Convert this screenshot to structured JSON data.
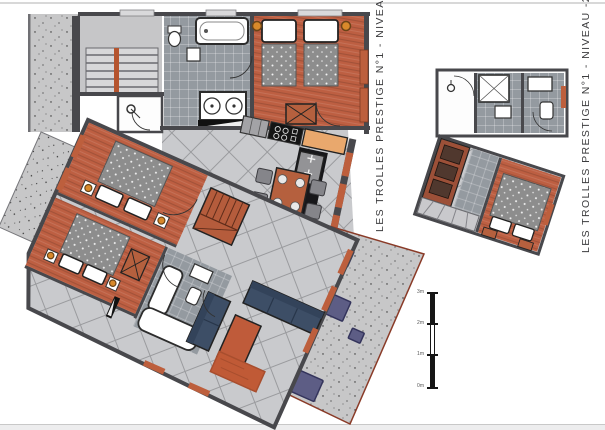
{
  "sheet": {
    "type": "architectural floor plan drawing",
    "captions": {
      "niveau1": "LES TROLLES PRESTIGE N°1 - NIVEAU -1",
      "niveau2": "LES TROLLES PRESTIGE N°1 - NIVEAU -2"
    },
    "scalebar": {
      "labels": [
        "3m",
        "2m",
        "1m",
        "0m"
      ]
    },
    "palette": {
      "wall": "#48484c",
      "wood_floor": "#bd5f42",
      "terracotta_accent": "#b55c3c",
      "bath_tile": "#949aa0",
      "hall_tile": "#c9cacd",
      "concrete": "#c7c7c8",
      "blanket_gray": "#8d8d8d",
      "sofa_navy": "#3d4e66",
      "terrace_furniture": "#5d5d85",
      "kitchen_counter_wood": "#e9a86d",
      "stove_black": "#141414",
      "terrace_outline": "#8a3b28"
    },
    "icons": [
      "bed",
      "bathtub",
      "shower",
      "toilet",
      "sink",
      "stove",
      "dining-table",
      "sofa",
      "stairs",
      "rug",
      "lamp",
      "scale-bar"
    ]
  }
}
